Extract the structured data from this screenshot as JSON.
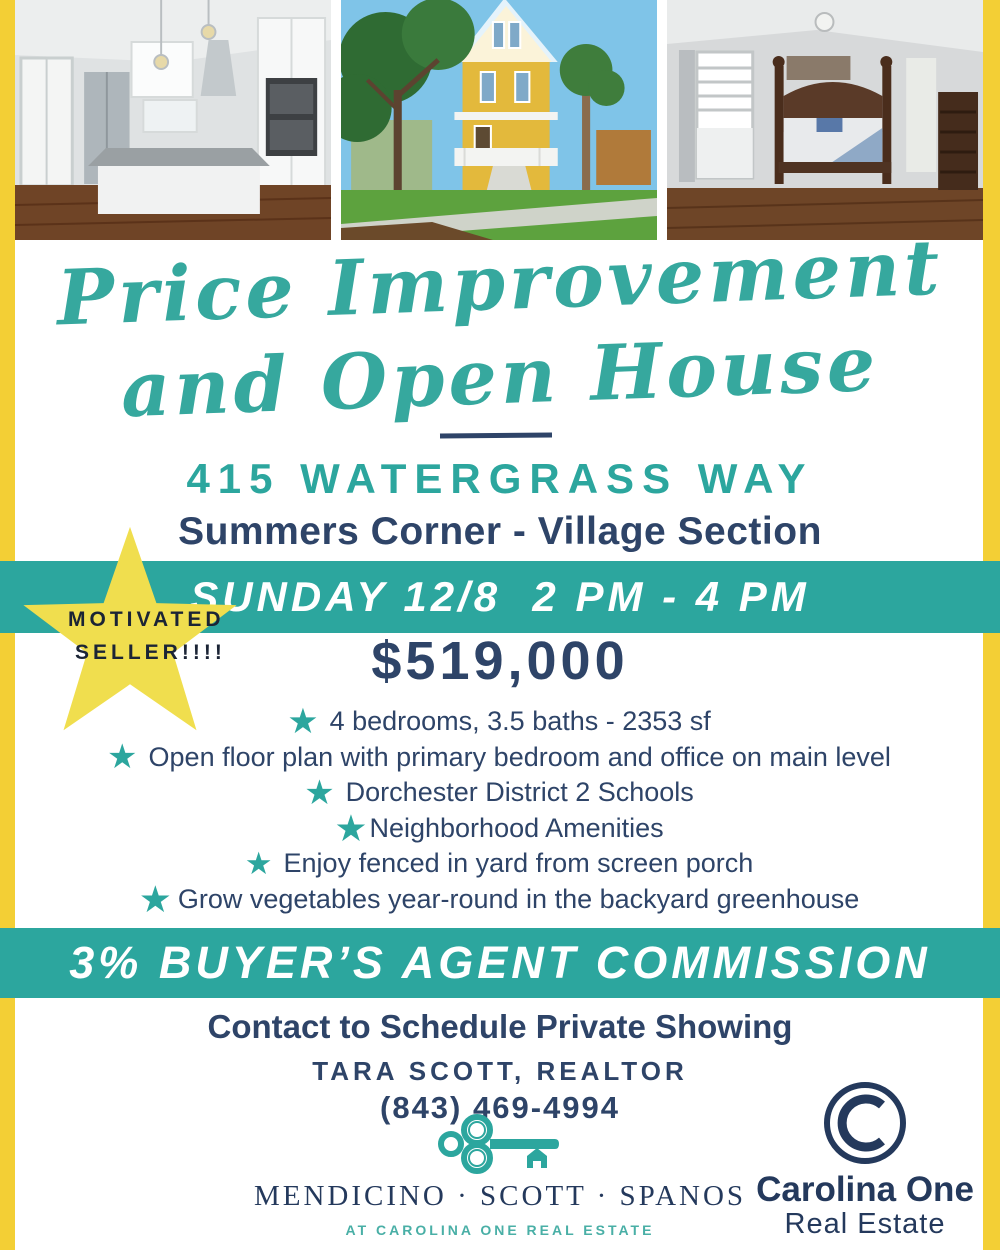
{
  "colors": {
    "teal_accent": "#2CA69E",
    "navy_text": "#2E4468",
    "yellow_border": "#F3CF35",
    "star_yellow": "#F0DE4E",
    "white": "#FFFFFF"
  },
  "photos": [
    {
      "name": "kitchen-photo",
      "description": "white kitchen with granite island and pendant lights"
    },
    {
      "name": "house-exterior-photo",
      "description": "yellow two-story house with front porch, trees and palms"
    },
    {
      "name": "bedroom-photo",
      "description": "bedroom with dark wood four-poster bed and shuttered window"
    }
  ],
  "headline": {
    "script_line1": "Price Improvement",
    "script_line2": "and Open House",
    "address": "415 WATERGRASS WAY",
    "subtitle": "Summers Corner - Village Section"
  },
  "open_house_banner": "SUNDAY 12/8  2 PM - 4 PM",
  "seller_badge": {
    "line1": "MOTIVATED",
    "line2": "SELLER!!!!"
  },
  "price": "$519,000",
  "features": [
    "4 bedrooms, 3.5 baths - 2353 sf",
    "Open floor plan with primary bedroom and office on main level",
    "Dorchester District 2 Schools",
    "Neighborhood Amenities",
    "Enjoy fenced in yard from screen porch",
    "Grow vegetables year-round in the backyard greenhouse"
  ],
  "commission_banner": "3% BUYER’S AGENT COMMISSION",
  "contact": {
    "heading": "Contact to Schedule Private Showing",
    "agent": "TARA SCOTT, REALTOR",
    "phone": "(843) 469-4994"
  },
  "team": {
    "names": "MENDICINO · SCOTT · SPANOS",
    "tagline": "AT CAROLINA ONE REAL ESTATE"
  },
  "brand": {
    "monogram": "C",
    "name": "Carolina One",
    "subname": "Real Estate"
  }
}
